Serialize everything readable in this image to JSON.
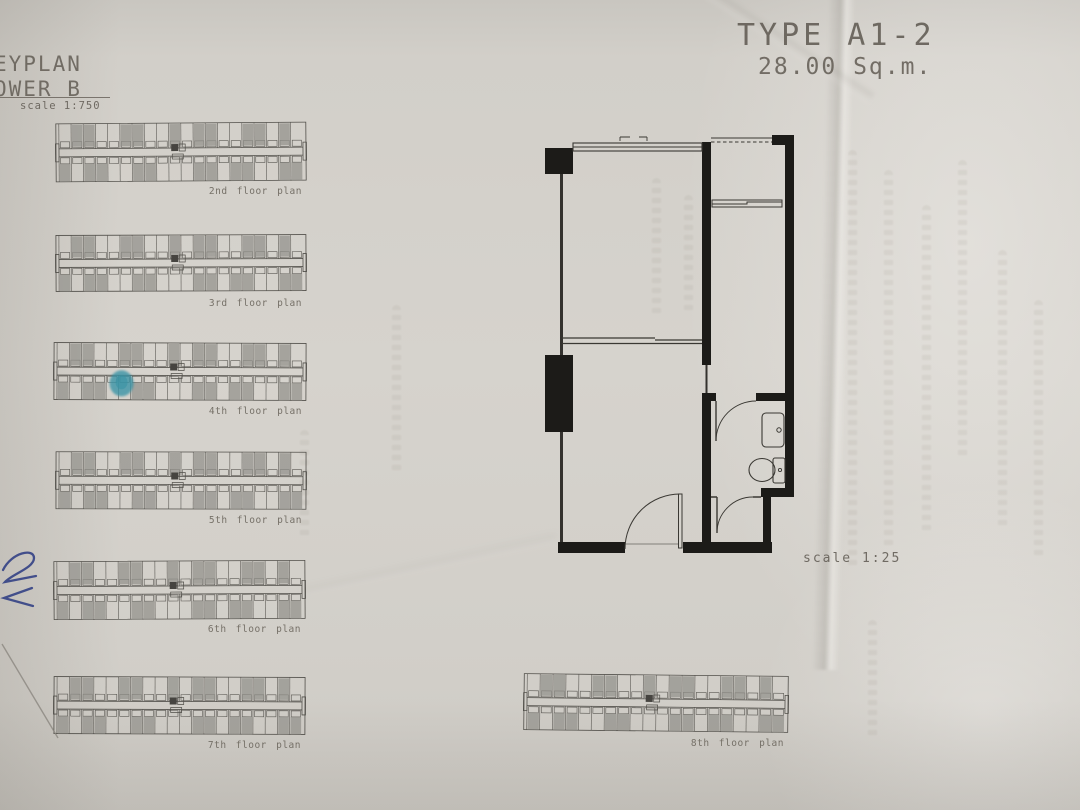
{
  "sheet": {
    "type_title": "TYPE A1-2",
    "area_label": "28.00 Sq.m.",
    "unit_scale_label": "scale 1:25"
  },
  "keyplan": {
    "header_line1": "EYPLAN",
    "header_line2": "OWER B",
    "scale_label": "scale 1:750",
    "floors": [
      {
        "label": "2nd floor plan",
        "highlight": false
      },
      {
        "label": "3rd floor plan",
        "highlight": false
      },
      {
        "label": "4th floor plan",
        "highlight": true
      },
      {
        "label": "5th floor plan",
        "highlight": false
      },
      {
        "label": "6th floor plan",
        "highlight": false
      },
      {
        "label": "7th floor plan",
        "highlight": false
      },
      {
        "label": "8th floor plan",
        "highlight": false
      }
    ],
    "strip_shading_top": [
      0,
      1,
      1,
      0,
      0,
      1,
      1,
      0,
      0,
      1,
      0,
      1,
      1,
      0,
      0,
      1,
      1,
      0,
      1,
      0
    ],
    "strip_shading_bottom": [
      1,
      0,
      1,
      1,
      0,
      0,
      1,
      1,
      0,
      0,
      0,
      1,
      1,
      0,
      1,
      1,
      0,
      0,
      1,
      1
    ],
    "highlight_color": "#2f8fa3"
  },
  "annotations": {
    "pen_mark": "blue-pen-scribble",
    "pencil_mark": "diagonal-pencil-line"
  },
  "colors": {
    "paper": "#d3d0ca",
    "line_ink": "#3a3833",
    "wall_ink": "#1c1b18",
    "unit_shade": "#8f8d88",
    "label_text": "#6e6962",
    "pen_ink": "#2b3a82",
    "pencil": "#8b8780"
  }
}
